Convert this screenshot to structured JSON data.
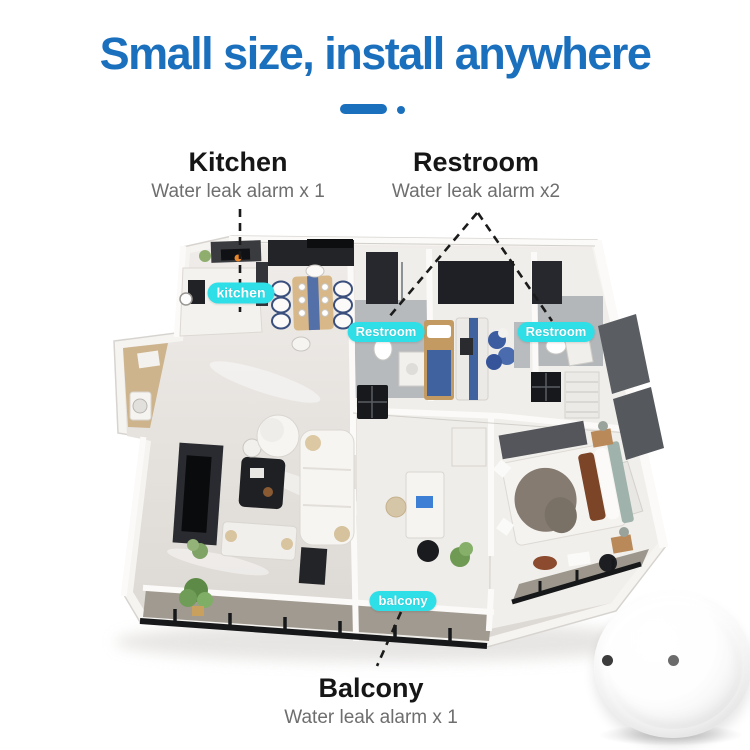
{
  "header": {
    "title": "Small size, install anywhere"
  },
  "callouts": [
    {
      "id": "kitchen",
      "heading": "Kitchen",
      "subtext": "Water leak alarm x 1"
    },
    {
      "id": "restroom",
      "heading": "Restroom",
      "subtext": "Water leak alarm x2"
    },
    {
      "id": "balcony",
      "heading": "Balcony",
      "subtext": "Water leak alarm x 1"
    }
  ],
  "floor_tags": [
    {
      "id": "kitchen",
      "label": "kitchen"
    },
    {
      "id": "restroom-left",
      "label": "Restroom"
    },
    {
      "id": "restroom-right",
      "label": "Restroom"
    },
    {
      "id": "balcony",
      "label": "balcony"
    }
  ],
  "device": {
    "name": "water-leak-sensor",
    "probe_dots": 2
  },
  "colors": {
    "accent_blue": "#1b70be",
    "tag_cyan": "#2fdfe8",
    "heading_black": "#161616",
    "subtext_gray": "#6e6e6e",
    "dashed_line": "#1b1b1b"
  }
}
